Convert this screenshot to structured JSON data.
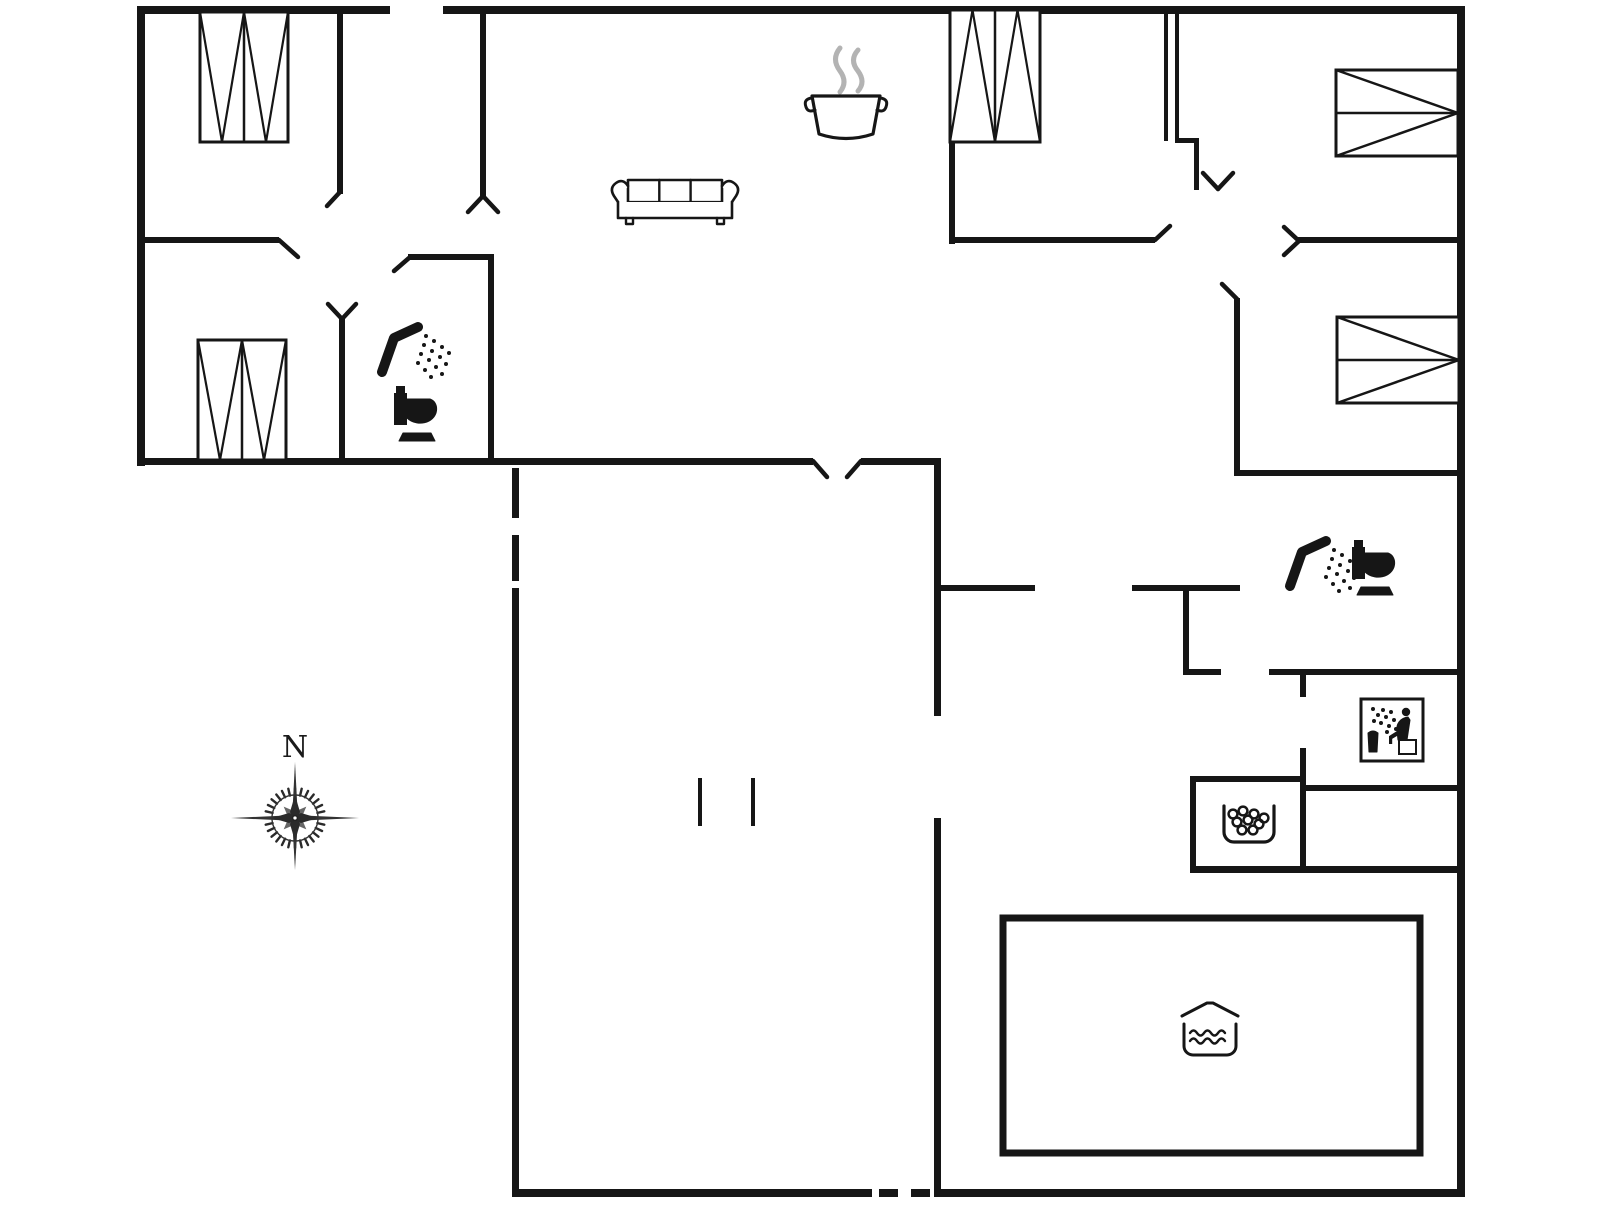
{
  "meta": {
    "type": "floor-plan",
    "width": 1606,
    "height": 1205,
    "bg_color": "#ffffff",
    "wall_color": "#161616",
    "steam_color": "#b3b3b3"
  },
  "compass": {
    "label": "N",
    "x": 295,
    "y": 818
  },
  "walls": [
    {
      "name": "outer-wall-top-left",
      "x": 140,
      "y": 6,
      "w": 250,
      "h": 8
    },
    {
      "name": "outer-wall-top-right",
      "x": 443,
      "y": 6,
      "w": 1022,
      "h": 8
    },
    {
      "name": "outer-wall-left",
      "x": 137,
      "y": 6,
      "w": 8,
      "h": 460
    },
    {
      "name": "outer-wall-right",
      "x": 1457,
      "y": 6,
      "w": 8,
      "h": 1191
    },
    {
      "name": "outer-wall-bottom-left",
      "x": 515,
      "y": 1189,
      "w": 357,
      "h": 8
    },
    {
      "name": "outer-wall-bottom-right",
      "x": 938,
      "y": 1189,
      "w": 527,
      "h": 8
    },
    {
      "name": "wing-bottom-wall-a",
      "x": 137,
      "y": 458,
      "w": 676,
      "h": 7
    },
    {
      "name": "wing-bottom-wall-b",
      "x": 861,
      "y": 458,
      "w": 80,
      "h": 7
    },
    {
      "name": "mid-vertical-wall-upper",
      "x": 934,
      "y": 458,
      "w": 7,
      "h": 258
    },
    {
      "name": "mid-vertical-wall-lower",
      "x": 934,
      "y": 818,
      "w": 7,
      "h": 379
    },
    {
      "name": "pool-hall-left-wall",
      "x": 512,
      "y": 588,
      "w": 7,
      "h": 609
    },
    {
      "name": "bedroom1-divider-wall",
      "x": 337,
      "y": 8,
      "w": 6,
      "h": 186
    },
    {
      "name": "bedroom2-top-wall",
      "x": 137,
      "y": 237,
      "w": 142,
      "h": 6
    },
    {
      "name": "entry-divider-wall",
      "x": 480,
      "y": 8,
      "w": 6,
      "h": 188
    },
    {
      "name": "bath-left-top-wall",
      "x": 408,
      "y": 254,
      "w": 86,
      "h": 6
    },
    {
      "name": "bath-left-right-wall",
      "x": 488,
      "y": 254,
      "w": 6,
      "h": 210
    },
    {
      "name": "bedroom2-right-wall",
      "x": 339,
      "y": 318,
      "w": 6,
      "h": 146
    },
    {
      "name": "bedroom3-left-wall",
      "x": 949,
      "y": 8,
      "w": 6,
      "h": 236
    },
    {
      "name": "bedroom3-bottom-wall",
      "x": 949,
      "y": 237,
      "w": 206,
      "h": 6
    },
    {
      "name": "double-door-line-a",
      "x": 1164,
      "y": 8,
      "w": 4,
      "h": 133
    },
    {
      "name": "double-door-line-b",
      "x": 1175,
      "y": 8,
      "w": 4,
      "h": 133
    },
    {
      "name": "double-door-connector",
      "x": 1175,
      "y": 138,
      "w": 24,
      "h": 5
    },
    {
      "name": "double-door-stub",
      "x": 1194,
      "y": 138,
      "w": 5,
      "h": 52
    },
    {
      "name": "hall-top-wall-right",
      "x": 1297,
      "y": 237,
      "w": 168,
      "h": 6
    },
    {
      "name": "bedroom4-divider-wall",
      "x": 1234,
      "y": 298,
      "w": 6,
      "h": 178
    },
    {
      "name": "bath-right-top-wall",
      "x": 1234,
      "y": 470,
      "w": 231,
      "h": 6
    },
    {
      "name": "bath-right-bottom-wall",
      "x": 1132,
      "y": 585,
      "w": 108,
      "h": 6
    },
    {
      "name": "hall-bottom-wall-left",
      "x": 934,
      "y": 585,
      "w": 101,
      "h": 6
    },
    {
      "name": "lobby-left-wall",
      "x": 1183,
      "y": 585,
      "w": 6,
      "h": 90
    },
    {
      "name": "lobby-bottom-wall",
      "x": 1183,
      "y": 669,
      "w": 38,
      "h": 6
    },
    {
      "name": "sauna-top-wall",
      "x": 1269,
      "y": 669,
      "w": 196,
      "h": 6
    },
    {
      "name": "sauna-left-wall-a",
      "x": 1300,
      "y": 669,
      "w": 6,
      "h": 28
    },
    {
      "name": "sauna-left-wall-b",
      "x": 1300,
      "y": 748,
      "w": 6,
      "h": 124
    },
    {
      "name": "sauna-bottom-wall",
      "x": 1300,
      "y": 785,
      "w": 165,
      "h": 6
    },
    {
      "name": "whirlpool-room-top-wall",
      "x": 1190,
      "y": 776,
      "w": 116,
      "h": 6
    },
    {
      "name": "whirlpool-room-left-wall",
      "x": 1190,
      "y": 776,
      "w": 6,
      "h": 96
    },
    {
      "name": "pool-hall-top-wall",
      "x": 1190,
      "y": 866,
      "w": 275,
      "h": 7
    },
    {
      "name": "passage-tick-a",
      "x": 698,
      "y": 778,
      "w": 4,
      "h": 48
    },
    {
      "name": "passage-tick-b",
      "x": 751,
      "y": 778,
      "w": 4,
      "h": 48
    }
  ],
  "dashes": [
    {
      "name": "dashed-wall-vertical-a",
      "x": 512,
      "y": 468,
      "w": 7,
      "h": 50
    },
    {
      "name": "dashed-wall-vertical-b",
      "x": 512,
      "y": 535,
      "w": 7,
      "h": 46
    },
    {
      "name": "dashed-door-bottom-a",
      "x": 879,
      "y": 1189,
      "w": 19,
      "h": 8
    },
    {
      "name": "dashed-door-bottom-b",
      "x": 911,
      "y": 1189,
      "w": 19,
      "h": 8
    }
  ],
  "door_marks": [
    {
      "name": "door-swing-bedroom2",
      "x1": 279,
      "y1": 240,
      "x2": 298,
      "y2": 257
    },
    {
      "name": "door-swing-bedroom1",
      "x1": 340,
      "y1": 192,
      "x2": 327,
      "y2": 206
    },
    {
      "name": "door-swing-entry-a",
      "x1": 483,
      "y1": 196,
      "x2": 468,
      "y2": 212
    },
    {
      "name": "door-swing-entry-b",
      "x1": 483,
      "y1": 196,
      "x2": 498,
      "y2": 212
    },
    {
      "name": "door-swing-bath-left",
      "x1": 409,
      "y1": 258,
      "x2": 394,
      "y2": 271
    },
    {
      "name": "door-swing-bedroom2b-a",
      "x1": 342,
      "y1": 319,
      "x2": 328,
      "y2": 304
    },
    {
      "name": "door-swing-bedroom2b-b",
      "x1": 342,
      "y1": 319,
      "x2": 356,
      "y2": 304
    },
    {
      "name": "door-swing-living-a",
      "x1": 813,
      "y1": 461,
      "x2": 827,
      "y2": 477
    },
    {
      "name": "door-swing-living-b",
      "x1": 861,
      "y1": 461,
      "x2": 847,
      "y2": 477
    },
    {
      "name": "door-swing-hall-a1",
      "x1": 1218,
      "y1": 189,
      "x2": 1203,
      "y2": 173
    },
    {
      "name": "door-swing-hall-a2",
      "x1": 1218,
      "y1": 189,
      "x2": 1233,
      "y2": 173
    },
    {
      "name": "door-swing-hall-b1",
      "x1": 1299,
      "y1": 241,
      "x2": 1284,
      "y2": 227
    },
    {
      "name": "door-swing-hall-b2",
      "x1": 1299,
      "y1": 241,
      "x2": 1284,
      "y2": 255
    },
    {
      "name": "door-swing-bedroom4",
      "x1": 1237,
      "y1": 299,
      "x2": 1222,
      "y2": 284
    },
    {
      "name": "door-swing-bedroom3",
      "x1": 1155,
      "y1": 240,
      "x2": 1170,
      "y2": 226
    }
  ],
  "beds": [
    {
      "name": "bed-top-left",
      "x": 200,
      "y": 12,
      "w": 88,
      "h": 130,
      "dir": "down"
    },
    {
      "name": "bed-bottom-left",
      "x": 198,
      "y": 340,
      "w": 88,
      "h": 120,
      "dir": "down"
    },
    {
      "name": "bed-top-right",
      "x": 950,
      "y": 10,
      "w": 90,
      "h": 132,
      "dir": "up"
    },
    {
      "name": "bed-right-1",
      "x": 1336,
      "y": 70,
      "w": 122,
      "h": 86,
      "dir": "right"
    },
    {
      "name": "bed-right-2",
      "x": 1337,
      "y": 317,
      "w": 122,
      "h": 86,
      "dir": "right"
    }
  ],
  "pool": {
    "name": "swimming-pool",
    "x": 1003,
    "y": 918,
    "w": 417,
    "h": 235
  },
  "icons": [
    {
      "type": "sofa",
      "name": "sofa-icon",
      "x": 610,
      "y": 178
    },
    {
      "type": "pot",
      "name": "cooking-pot-icon",
      "x": 804,
      "y": 94
    },
    {
      "type": "shower",
      "name": "shower-icon-left",
      "x": 378,
      "y": 322
    },
    {
      "type": "toilet",
      "name": "toilet-icon-left",
      "x": 394,
      "y": 386
    },
    {
      "type": "shower",
      "name": "shower-icon-right",
      "x": 1286,
      "y": 536
    },
    {
      "type": "toilet",
      "name": "toilet-icon-right",
      "x": 1352,
      "y": 540
    },
    {
      "type": "sauna",
      "name": "sauna-icon",
      "x": 1361,
      "y": 699
    },
    {
      "type": "whirlpool",
      "name": "whirlpool-icon",
      "x": 1221,
      "y": 806
    },
    {
      "type": "poolwater",
      "name": "pool-water-icon",
      "x": 1182,
      "y": 1000
    }
  ]
}
